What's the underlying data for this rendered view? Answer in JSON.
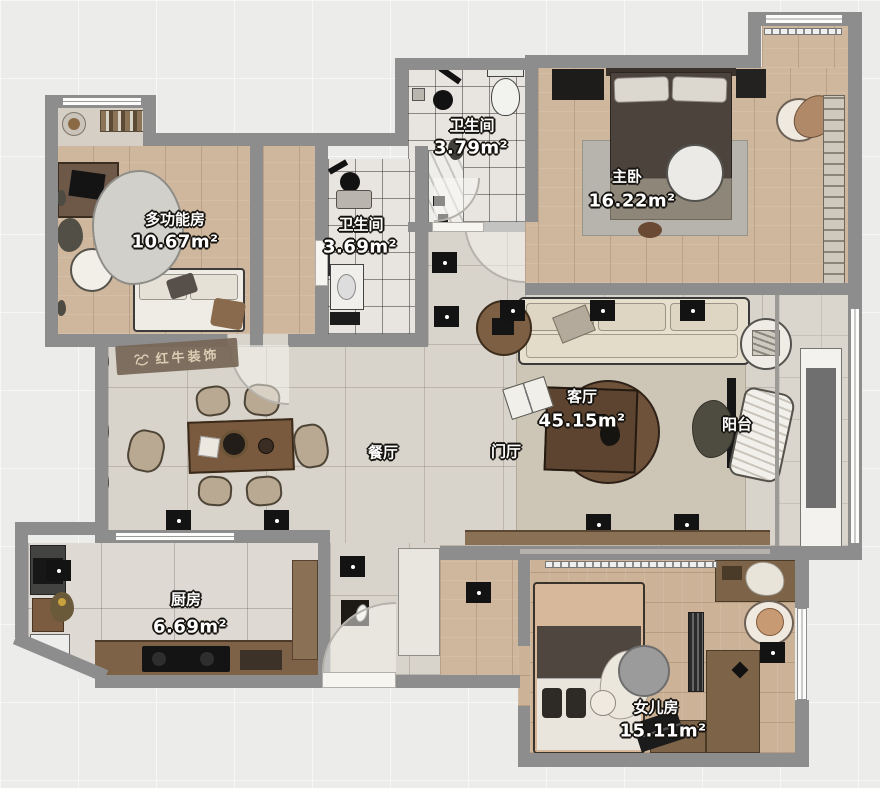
{
  "watermark": {
    "brand": "红牛装饰"
  },
  "rooms": {
    "multifunction": {
      "name": "多功能房",
      "area": "10.67m²"
    },
    "bath_top": {
      "name": "卫生间",
      "area": "3.79m²"
    },
    "bath_mid": {
      "name": "卫生间",
      "area": "3.69m²"
    },
    "master": {
      "name": "主卧",
      "area": "16.22m²"
    },
    "living": {
      "name": "客厅",
      "area": "45.15m²"
    },
    "dining": {
      "name": "餐厅"
    },
    "foyer": {
      "name": "门厅"
    },
    "balcony": {
      "name": "阳台"
    },
    "kitchen": {
      "name": "厨房",
      "area": "6.69m²"
    },
    "daughter": {
      "name": "女儿房",
      "area": "15.11m²"
    }
  },
  "colors": {
    "wall": "#8d8d8d",
    "wood_floor": "#cfb79e",
    "tile_floor": "#d8d3cb",
    "bath_tile": "#e8e5e1",
    "label_text": "#ffffff",
    "spotlight": "#131313",
    "watermark_bg": "#766656"
  }
}
